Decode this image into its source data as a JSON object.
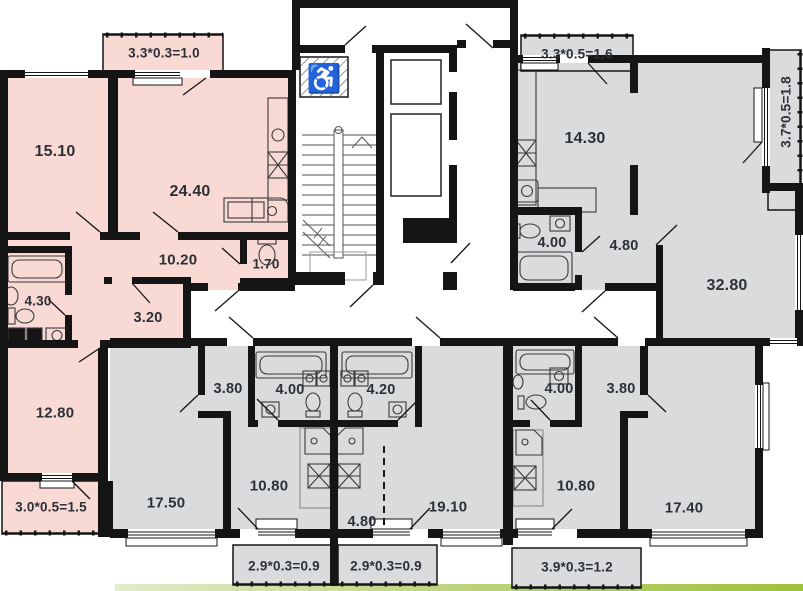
{
  "plan": {
    "type": "residential-floor-plan",
    "apartments": {
      "top_left": {
        "balcony_top": "3.3*0.3=1.0",
        "living_room": "15.10",
        "kitchen_living": "24.40",
        "hallway": "10.20",
        "bathroom": "4.30",
        "storage": "3.20",
        "wc": "1.70",
        "bedroom": "12.80",
        "balcony_bottom": "3.0*0.5=1.5"
      },
      "top_right": {
        "balcony_top": "3.3*0.5=1.6",
        "balcony_right": "3.7*0.5=1.8",
        "kitchen": "14.30",
        "bathroom": "4.00",
        "hallway": "4.80",
        "living_room": "32.80"
      },
      "bottom_left": {
        "hallway": "3.80",
        "bathroom": "4.00",
        "kitchen_living": "10.80",
        "room": "17.50",
        "balcony": "2.9*0.3=0.9"
      },
      "bottom_middle": {
        "bathroom": "4.20",
        "kitchen_niche": "4.80",
        "living_room": "19.10",
        "balcony": "2.9*0.3=0.9"
      },
      "bottom_right": {
        "bathroom": "4.00",
        "hallway": "3.80",
        "kitchen_living": "10.80",
        "room": "17.40",
        "balcony": "3.9*0.3=1.2"
      }
    },
    "icons": {
      "wheelchair": "♿"
    },
    "colors": {
      "apartment_pink": "#f8d9d4",
      "apartment_gray": "#d9dbdd",
      "wall": "#151515",
      "ground_green": "#9dc23c",
      "text": "#2c3037"
    }
  }
}
